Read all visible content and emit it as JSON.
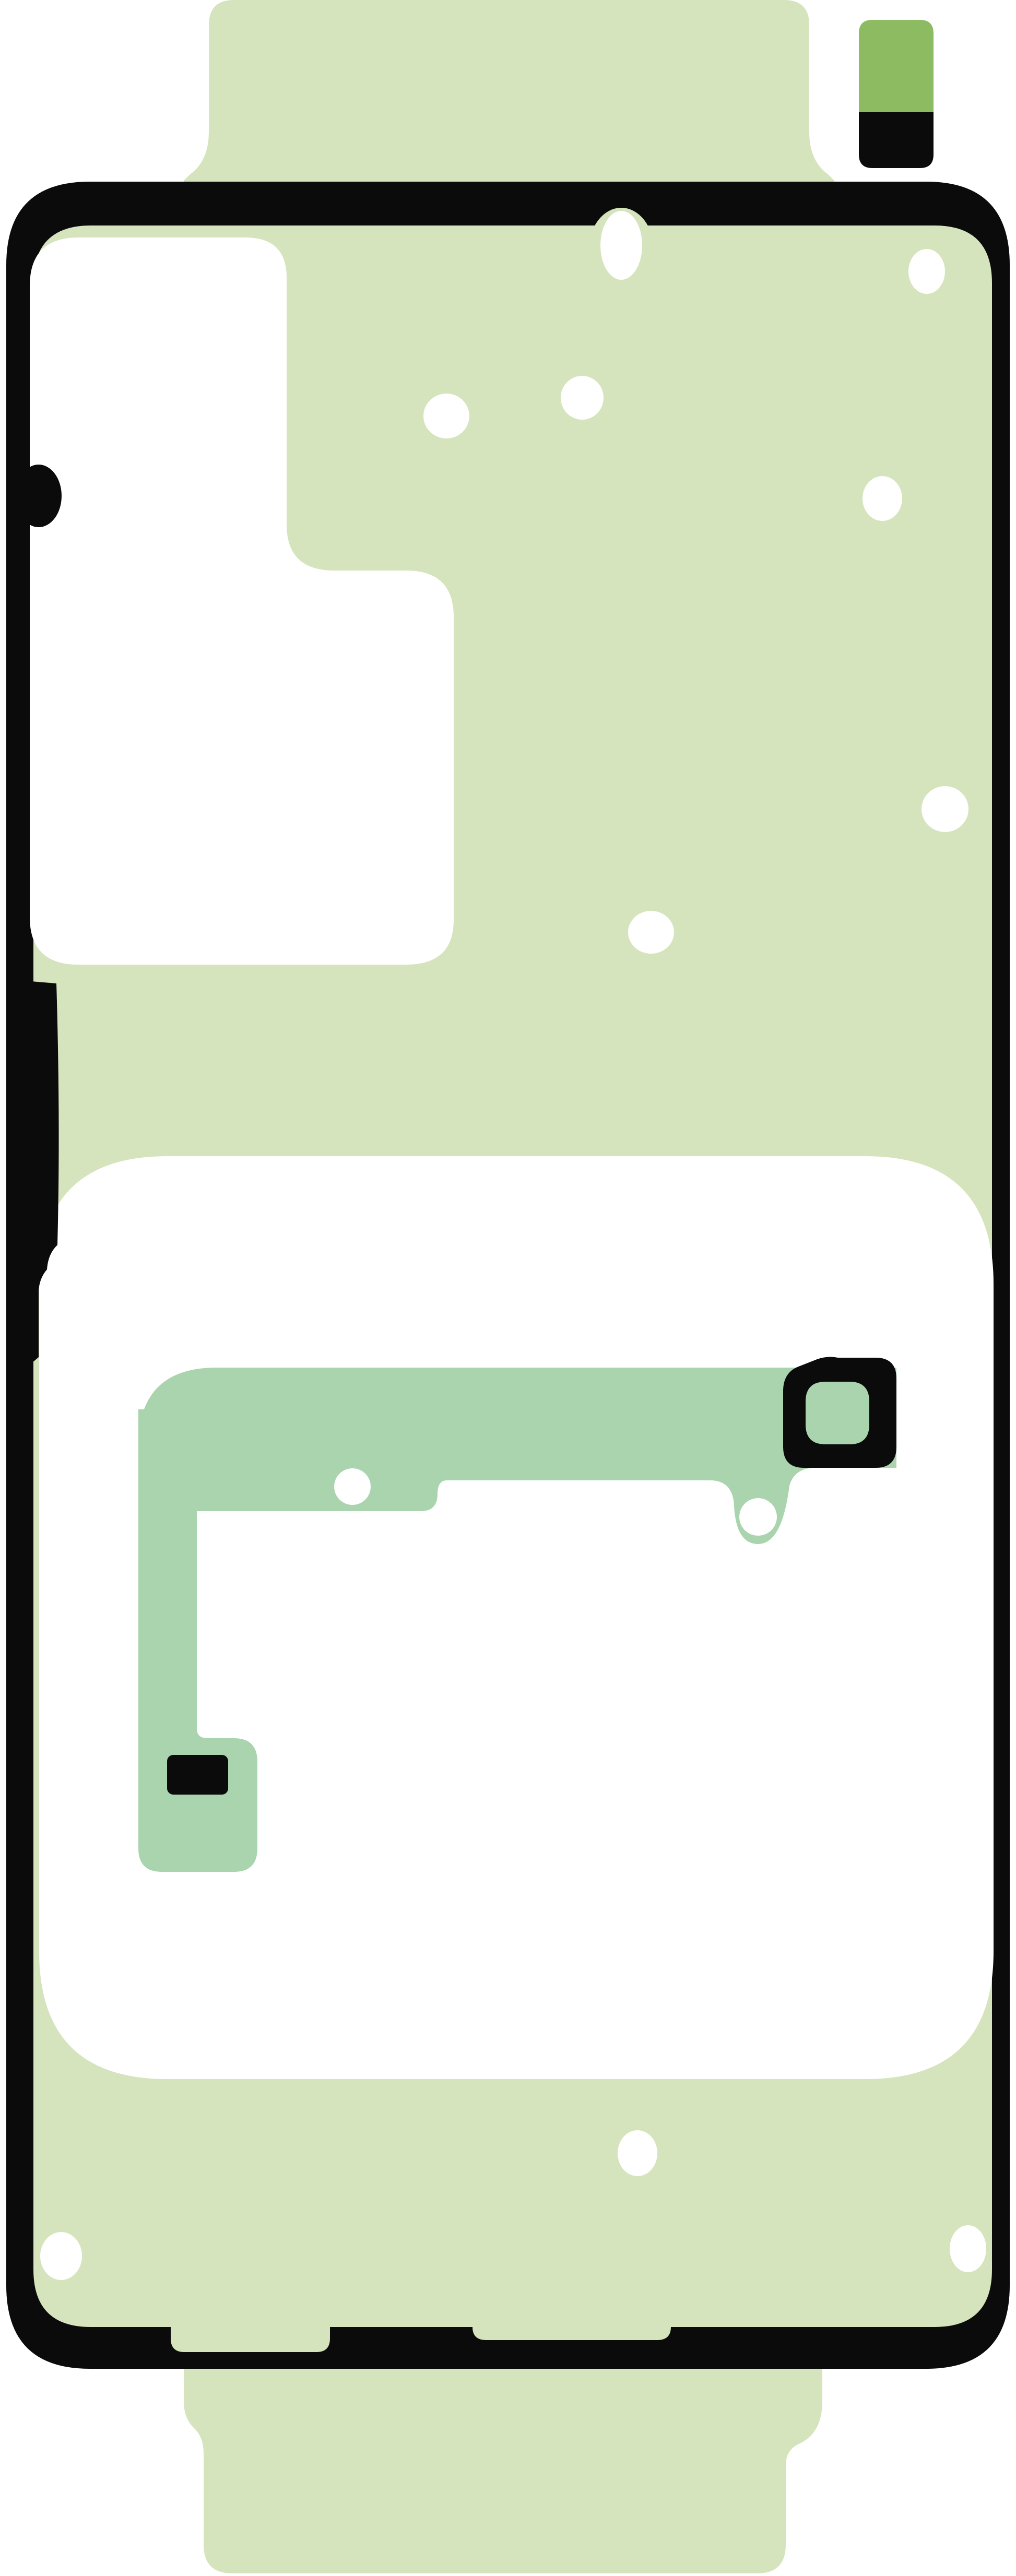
{
  "figure": {
    "title": "Smartphone back cover adhesive sheet (die-cut template)",
    "description": "Flat vector illustration of a rework adhesive kit: pale green liner silhouette with black die-cut gasket outline, white camera-island and battery cutouts, mint adhesive strip with camera-ring surround, and a small olive/black pull tab at the top right.",
    "parts": [
      {
        "name": "liner-silhouette",
        "label": "Adhesive liner sheet"
      },
      {
        "name": "gasket-outline",
        "label": "Black perimeter adhesive gasket"
      },
      {
        "name": "camera-island-cutout",
        "label": "Camera island cutout"
      },
      {
        "name": "battery-cutout",
        "label": "Battery area cutout"
      },
      {
        "name": "adhesive-strip",
        "label": "Mint flex adhesive strip"
      },
      {
        "name": "camera-ring",
        "label": "Camera lens surround"
      },
      {
        "name": "pull-tab-top-right",
        "label": "Small pull tab (olive/black)"
      },
      {
        "name": "pull-tab-top",
        "label": "Top liner tab"
      },
      {
        "name": "pull-tab-bottom",
        "label": "Bottom liner tab"
      }
    ],
    "alignment_hole_count": 12,
    "strip_hole_count": 2
  },
  "colors": {
    "background": "#ffffff",
    "liner_green": "#d5e4bd",
    "adhesive_mint": "#a9d4ae",
    "outline_black": "#0b0b0b",
    "tab_olive": "#8dbb61",
    "cutout_white": "#ffffff"
  }
}
